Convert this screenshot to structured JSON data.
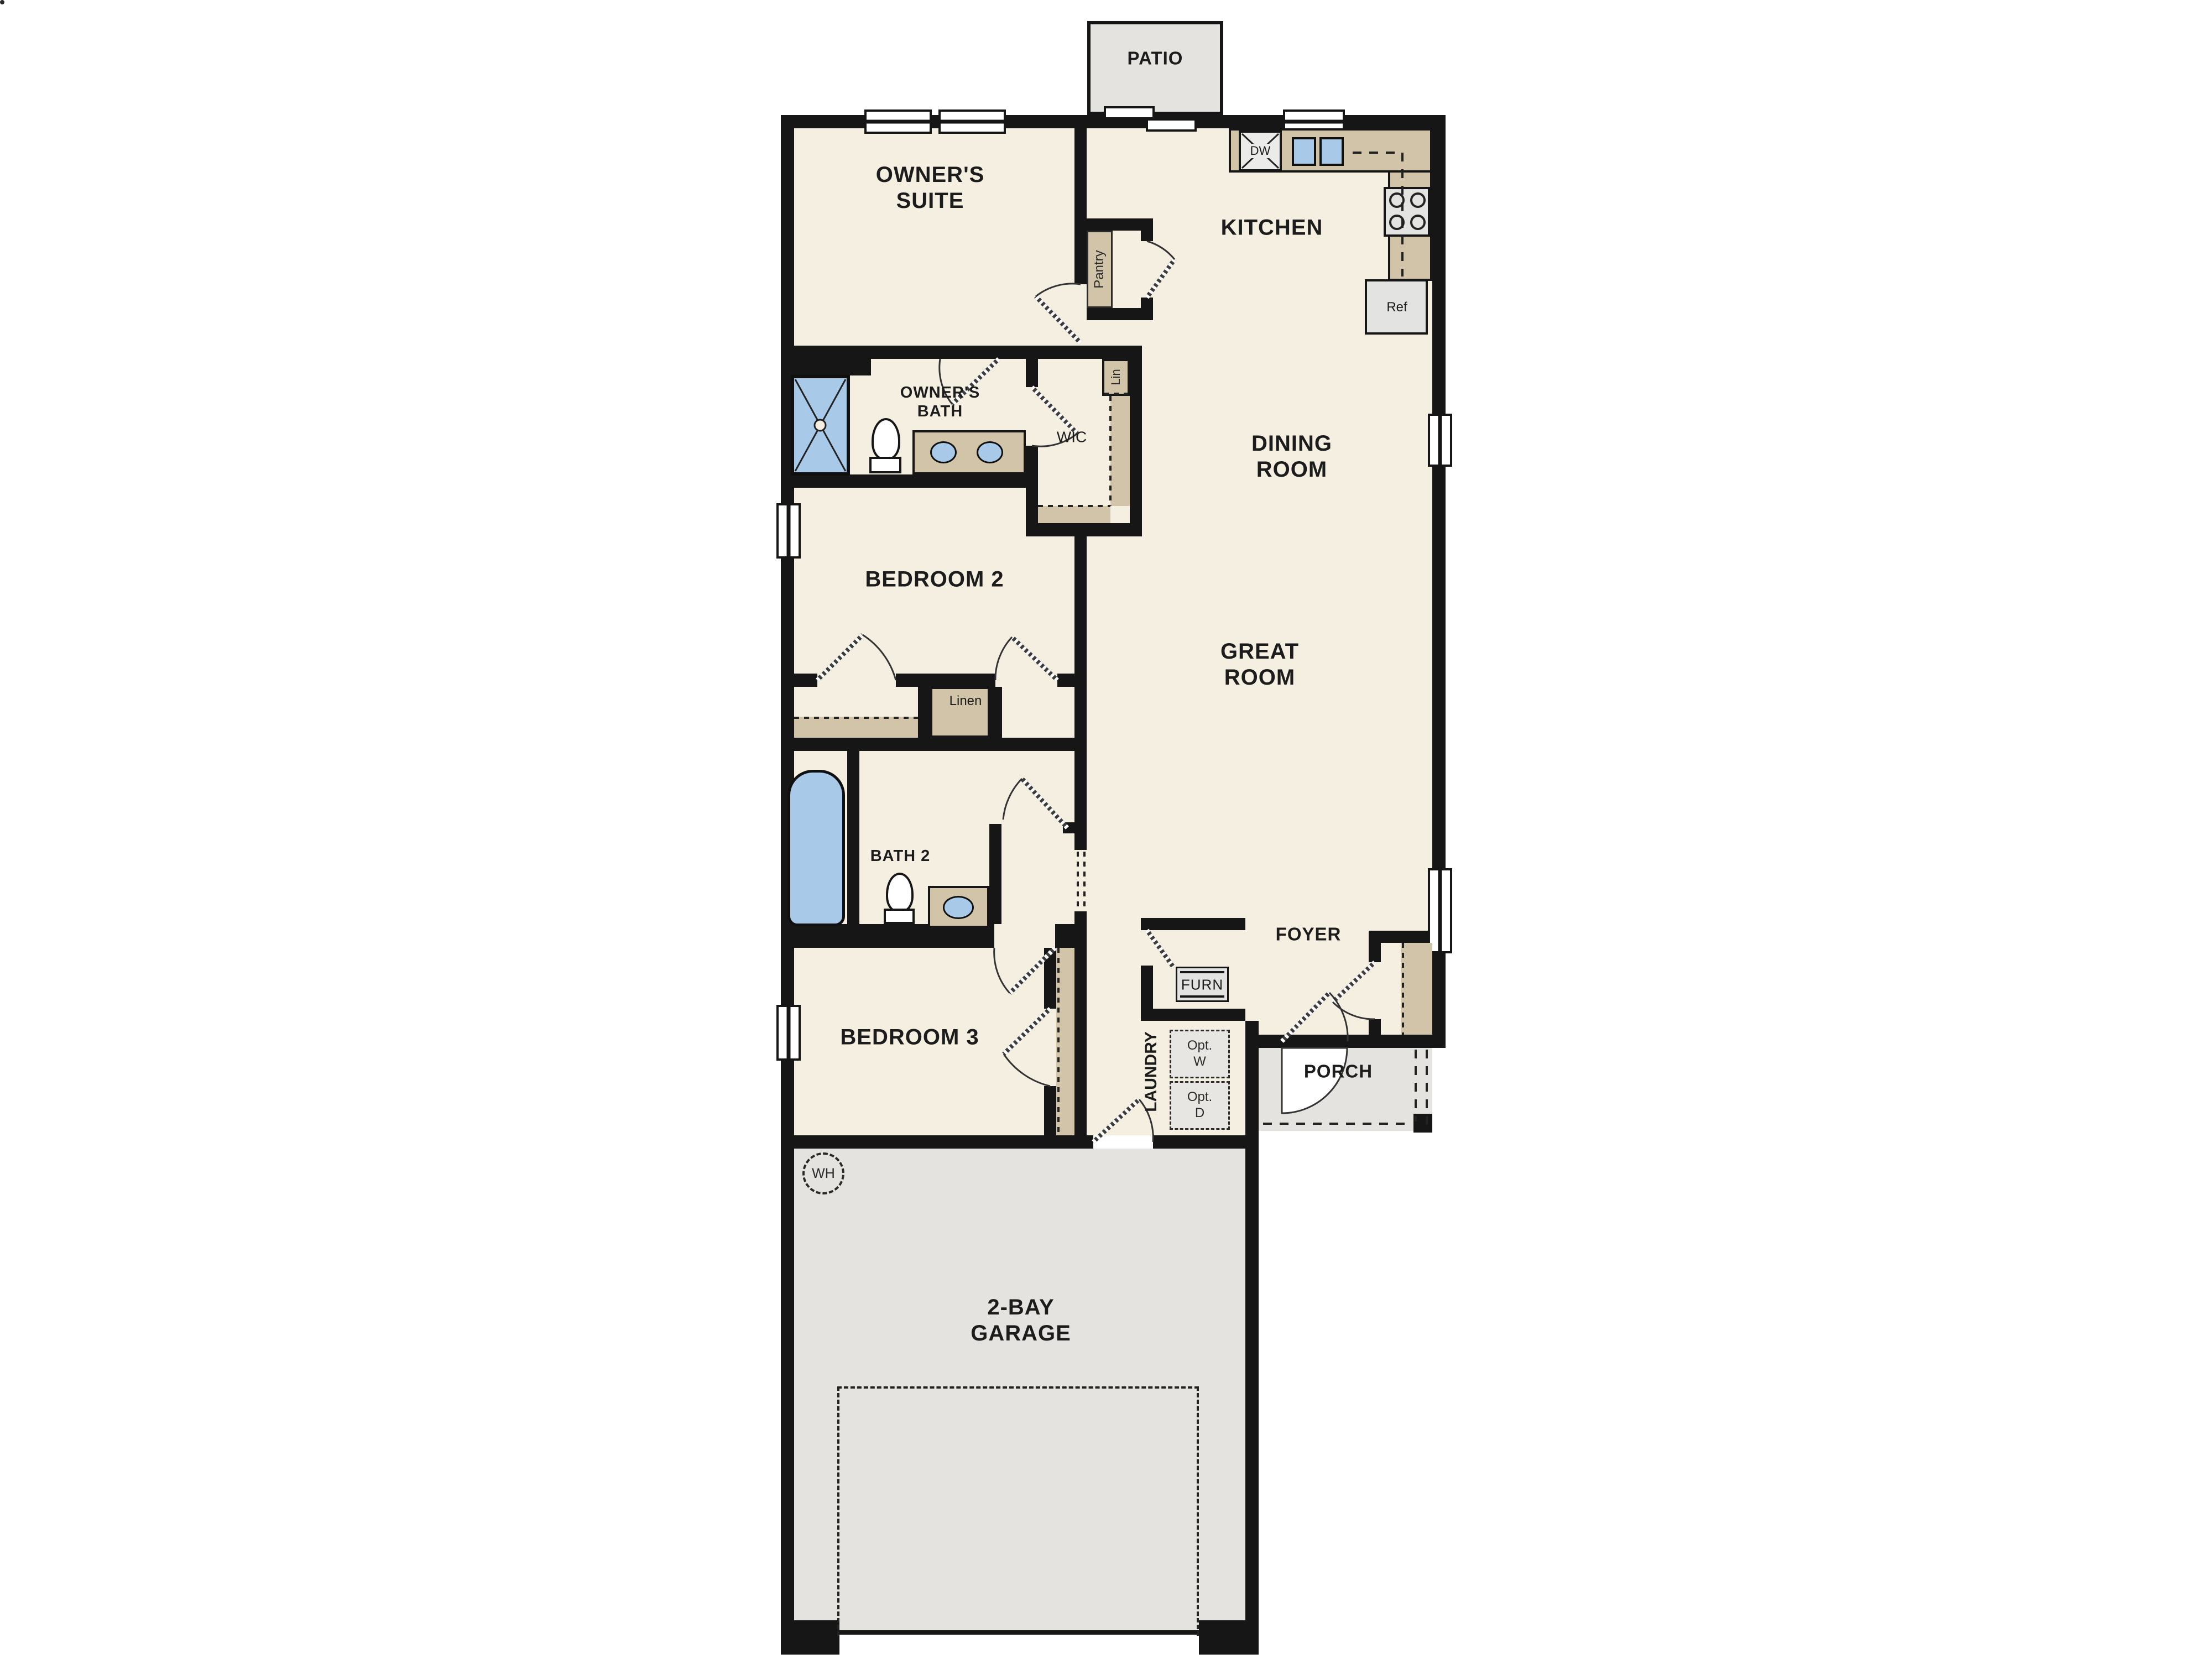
{
  "plan_title": "single-story floor plan",
  "outdoor": {
    "patio": "PATIO",
    "porch": "PORCH"
  },
  "rooms": {
    "owners_suite": "OWNER'S\nSUITE",
    "kitchen": "KITCHEN",
    "dining_room": "DINING\nROOM",
    "owners_bath": "OWNER'S\nBATH",
    "wic": "WIC",
    "bedroom2": "BEDROOM 2",
    "bath2": "BATH 2",
    "great_room": "GREAT\nROOM",
    "foyer": "FOYER",
    "bedroom3": "BEDROOM 3",
    "laundry": "LAUNDRY",
    "garage": "2-BAY\nGARAGE"
  },
  "closets": {
    "pantry": "Pantry",
    "lin": "Lin",
    "linen": "Linen"
  },
  "fixtures": {
    "dishwasher": "DW",
    "refrigerator": "Ref",
    "furnace": "FURN",
    "optional_washer": "Opt.\nW",
    "optional_dryer": "Opt.\nD",
    "water_heater": "WH"
  },
  "colors": {
    "floor": "#f5efe2",
    "wall": "#161616",
    "cabinet_tan": "#d1c4a9",
    "outdoor_gray": "#e4e3e0",
    "fixture_blue": "#a9c9e9"
  }
}
